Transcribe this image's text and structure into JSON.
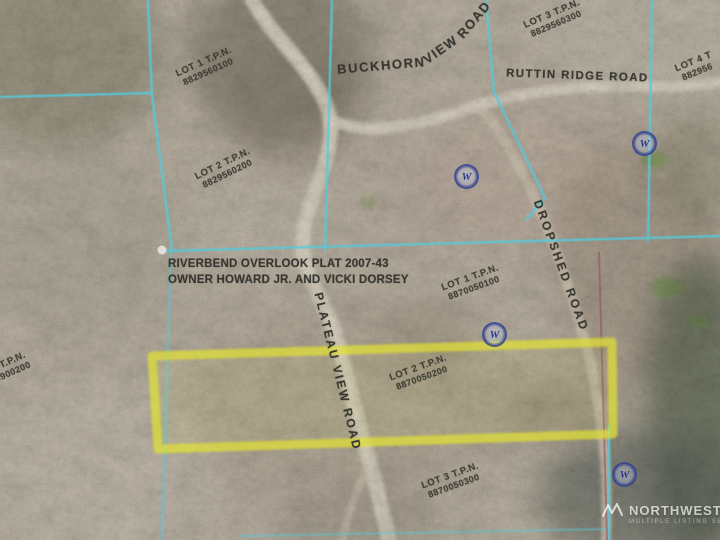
{
  "plat": {
    "name": "RIVERBEND OVERLOOK PLAT 2007-43",
    "owner": "OWNER HOWARD JR. AND VICKI DORSEY"
  },
  "roads": {
    "buckhorn_word1": "BUCKHORN",
    "buckhorn_word2": "VIEW",
    "buckhorn_word3": "ROAD",
    "ruttin_ridge": "RUTTIN RIDGE ROAD",
    "dropshed": "DROPSHED ROAD",
    "plateau_view": "PLATEAU VIEW ROAD"
  },
  "lots": [
    {
      "label": "LOT 1 T.P.N.",
      "parcel": "8829560100",
      "position": "top-left"
    },
    {
      "label": "LOT 2 T.P.N.",
      "parcel": "8829560200",
      "position": "left"
    },
    {
      "label": "LOT 3 T.P.N.",
      "parcel": "8829560300",
      "position": "top-right"
    },
    {
      "label": "LOT 4 T",
      "parcel": "882956",
      "position": "right-edge-clipped"
    },
    {
      "label": "LOT 1 T.P.N.",
      "parcel": "8870050100",
      "position": "center"
    },
    {
      "label": "LOT 2 T.P.N.",
      "parcel": "8870050200",
      "position": "highlighted-parcel"
    },
    {
      "label": "LOT 3 T.P.N.",
      "parcel": "8870050300",
      "position": "bottom"
    },
    {
      "label": "2 T.P.N.",
      "parcel": "0900200",
      "position": "left-edge-clipped"
    }
  ],
  "well_markers": {
    "letter": "W"
  },
  "watermark": {
    "brand": "NORTHWEST",
    "subtitle": "MULTIPLE LISTING SERVICE"
  },
  "highlight": {
    "stroke_color": "#e4e432",
    "description": "yellow marker outline around highlighted parcel"
  },
  "colors": {
    "parcel_line": "#56c9da",
    "boundary_secondary": "#94525c",
    "well_symbol": "#2b3a8f",
    "label_text": "#3a3a34",
    "terrain_base": "#c5bcac",
    "road": "#e3dbca"
  }
}
